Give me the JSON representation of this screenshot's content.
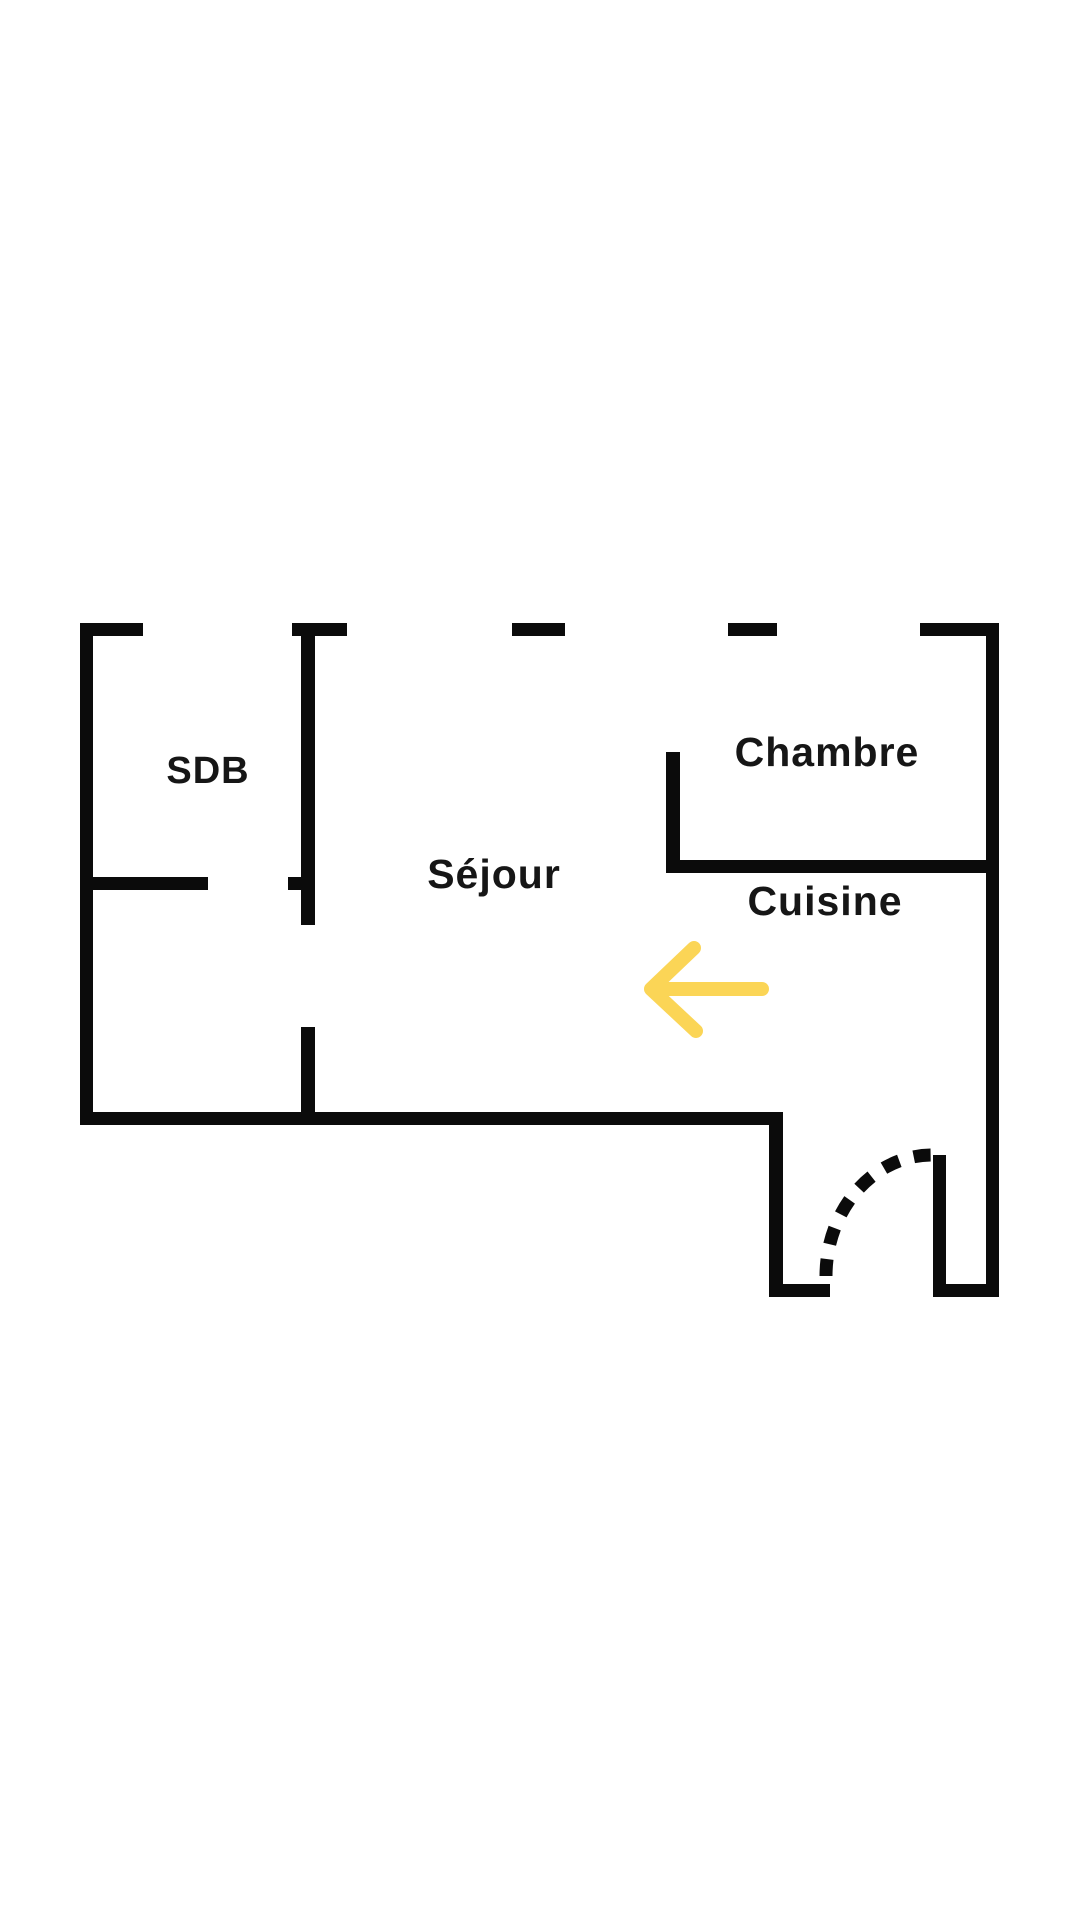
{
  "page": {
    "background": "#ffffff"
  },
  "colors": {
    "background": "#ffffff",
    "wall": "#0b0b0b",
    "text": "#161616",
    "arrow": "#fbd556"
  },
  "floorplan": {
    "type": "apartment-floor-plan",
    "rooms": [
      {
        "id": "sdb",
        "label": "SDB"
      },
      {
        "id": "sejour",
        "label": "Séjour"
      },
      {
        "id": "chambre",
        "label": "Chambre"
      },
      {
        "id": "cuisine",
        "label": "Cuisine"
      }
    ],
    "annotations": [
      {
        "id": "direction-arrow",
        "kind": "arrow",
        "direction": "left",
        "color": "#fbd556"
      },
      {
        "id": "entrance-door",
        "kind": "door-swing",
        "style": "dashed"
      }
    ]
  }
}
